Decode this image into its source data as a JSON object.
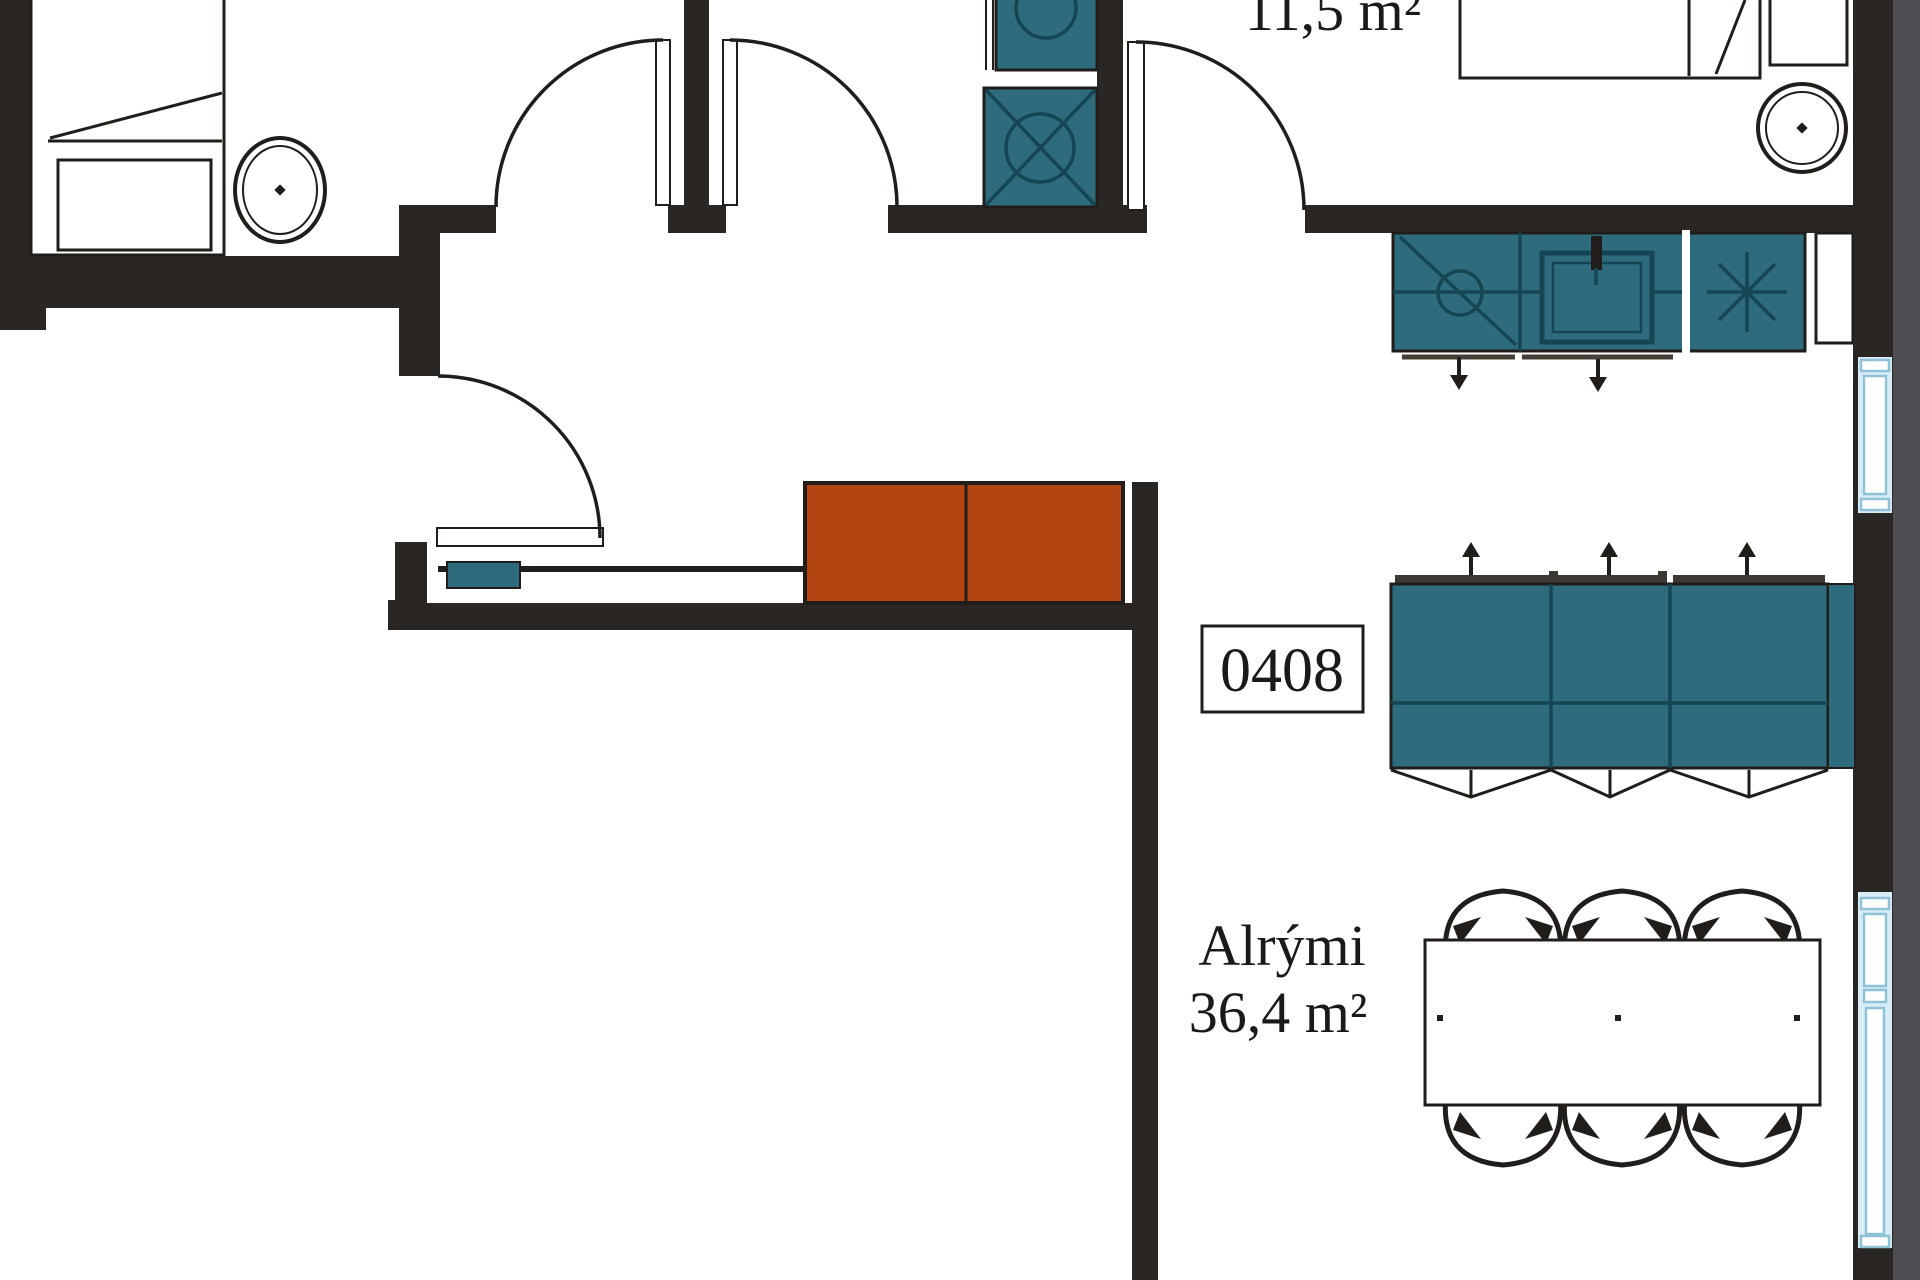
{
  "title": "Apartment floor plan",
  "labels": {
    "bedroom_area": "11,5 m²",
    "unit_number": "0408",
    "living_room_name": "Alrými",
    "living_room_area": "36,4 m²"
  },
  "colors": {
    "background": "#ffffff",
    "wall": "#2a2624",
    "outline": "#201d1a",
    "furniture_teal": "#2d6b7d",
    "teal_detail": "#164653",
    "sofa_orange": "#b24512",
    "window_fill": "#d8edf6",
    "window_line": "#8fc2d6",
    "facade_gray": "#4e4d52",
    "track_dark": "#3c3834"
  }
}
